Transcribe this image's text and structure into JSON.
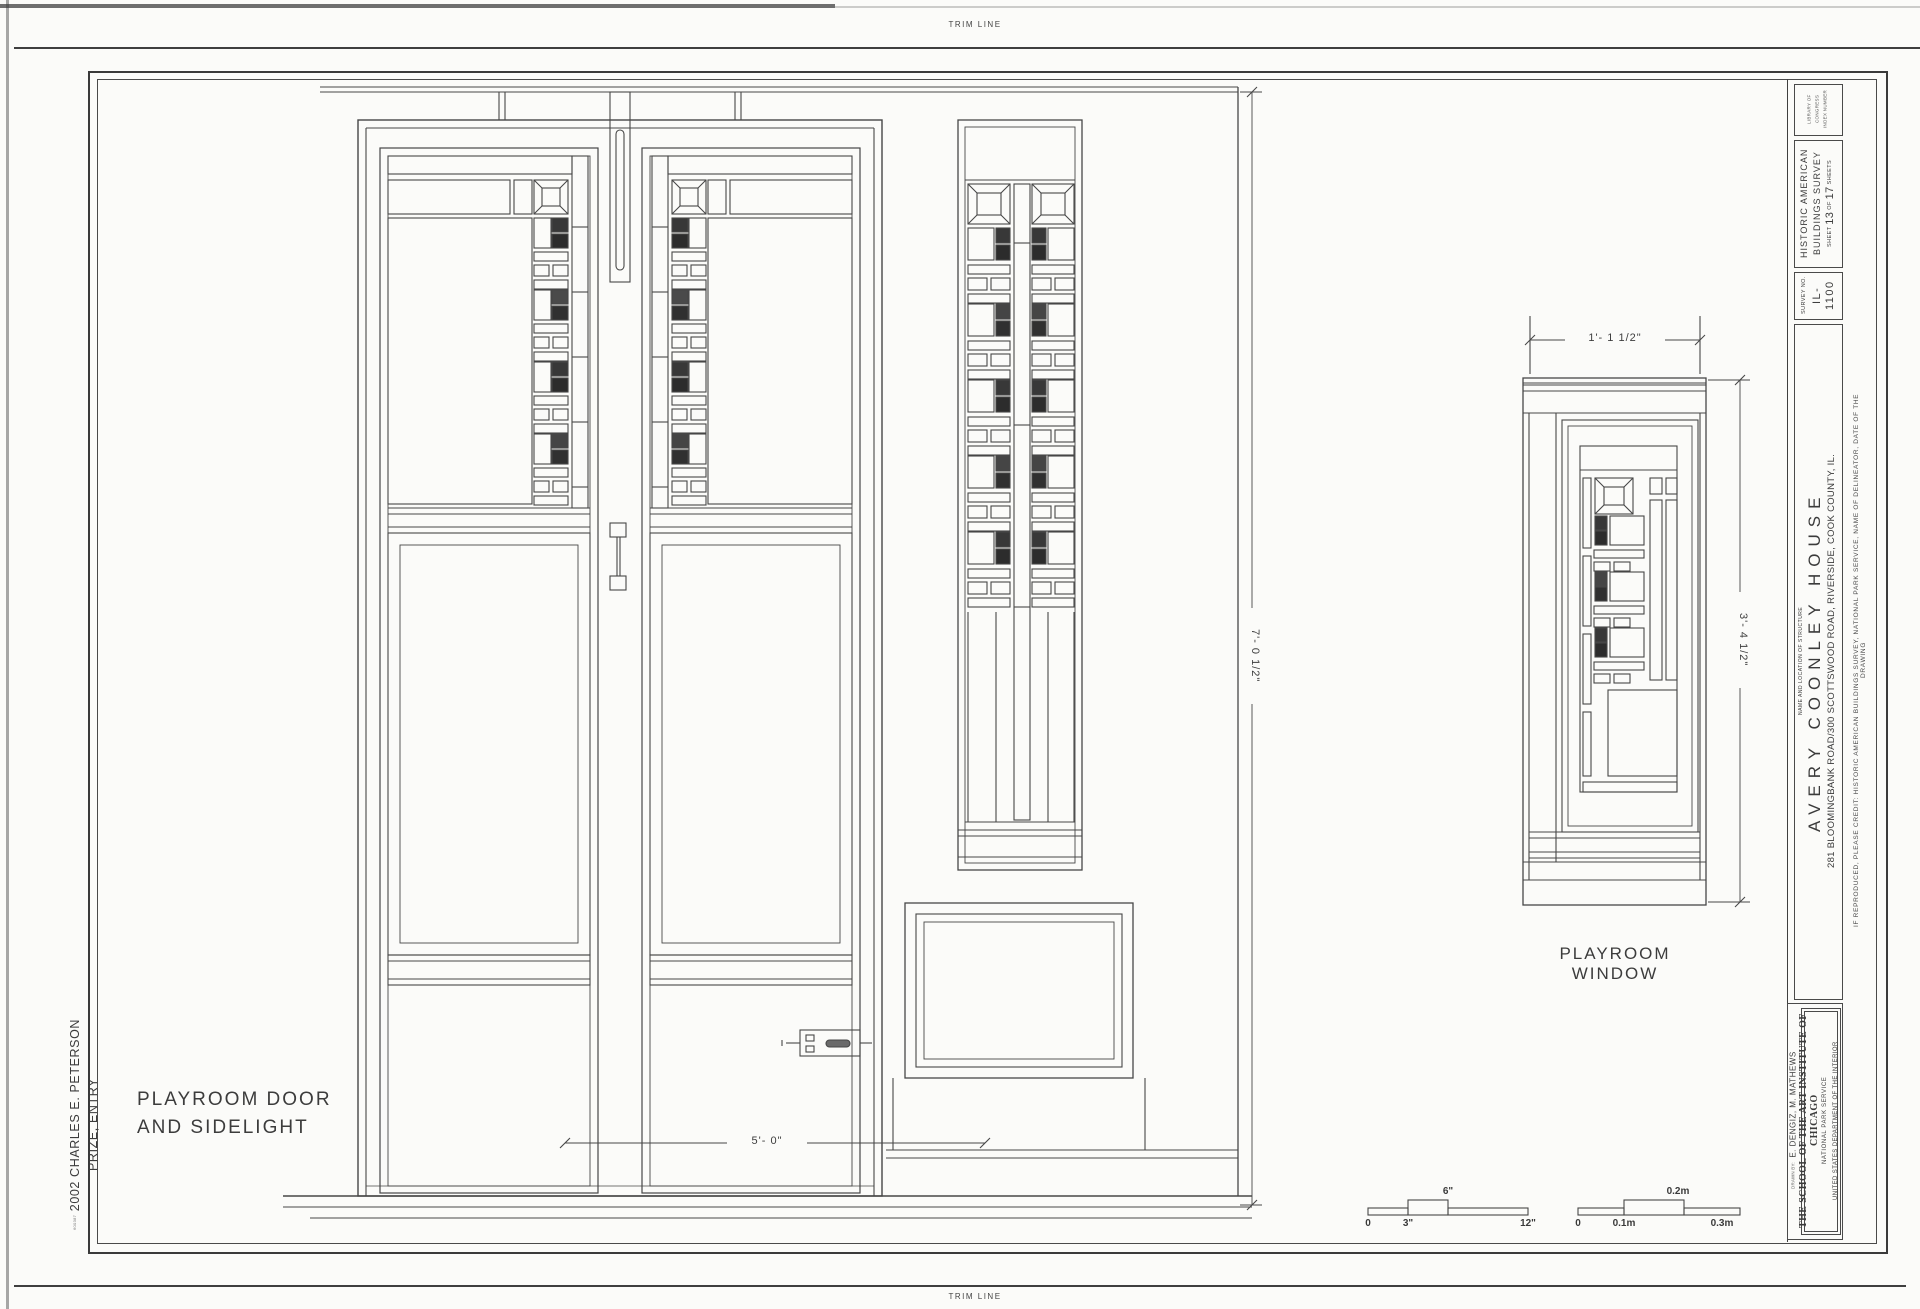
{
  "palette": {
    "paper": "#fbfbf9",
    "ink": "#454545",
    "glass_dark": "#383838"
  },
  "trim": {
    "top": "TRIM LINE",
    "bottom": "TRIM LINE"
  },
  "margin_note": {
    "catalog": "600387",
    "prize": "2002 CHARLES E. PETERSON PRIZE, ENTRY"
  },
  "labels": {
    "door_line1": "PLAYROOM DOOR",
    "door_line2": "AND SIDELIGHT",
    "window": "PLAYROOM WINDOW"
  },
  "dimensions": {
    "door_width": "5'- 0\"",
    "door_height": "7'- 0 1/2\"",
    "window_width": "1'- 1 1/2\"",
    "window_height": "3'- 4 1/2\""
  },
  "scale_imperial": {
    "ticks": [
      "0",
      "3\"",
      "6\"",
      "12\""
    ]
  },
  "scale_metric": {
    "ticks": [
      "0",
      "0.1m",
      "0.2m",
      "0.3m"
    ]
  },
  "titleblock": {
    "loc_label_1": "LIBRARY OF CONGRESS",
    "loc_label_2": "INDEX NUMBER",
    "habs_1": "HISTORIC AMERICAN",
    "habs_2": "BUILDINGS SURVEY",
    "sheet_word": "SHEET",
    "sheet_no": "13",
    "of_word": "OF",
    "sheet_total": "17",
    "sheets_word": "SHEETS",
    "survey_label": "SURVEY NO.",
    "survey_no": "IL-1100",
    "name_label": "NAME AND LOCATION OF STRUCTURE",
    "structure_name": "AVERY COONLEY HOUSE",
    "structure_address": "281 BLOOMINGBANK ROAD/300 SCOTTSWOOD ROAD, RIVERSIDE, COOK COUNTY, IL.",
    "credit": "IF REPRODUCED, PLEASE CREDIT: HISTORIC AMERICAN BUILDINGS SURVEY, NATIONAL PARK SERVICE, NAME OF DELINEATOR, DATE OF THE DRAWING",
    "drawn_by_label": "DRAWN BY:",
    "drawn_by": "E. DENGIZ, M. MATHEWS",
    "school": "THE SCHOOL OF THE ART INSTITUTE OF CHICAGO",
    "agency": "NATIONAL PARK SERVICE",
    "department": "UNITED STATES DEPARTMENT OF THE INTERIOR"
  }
}
